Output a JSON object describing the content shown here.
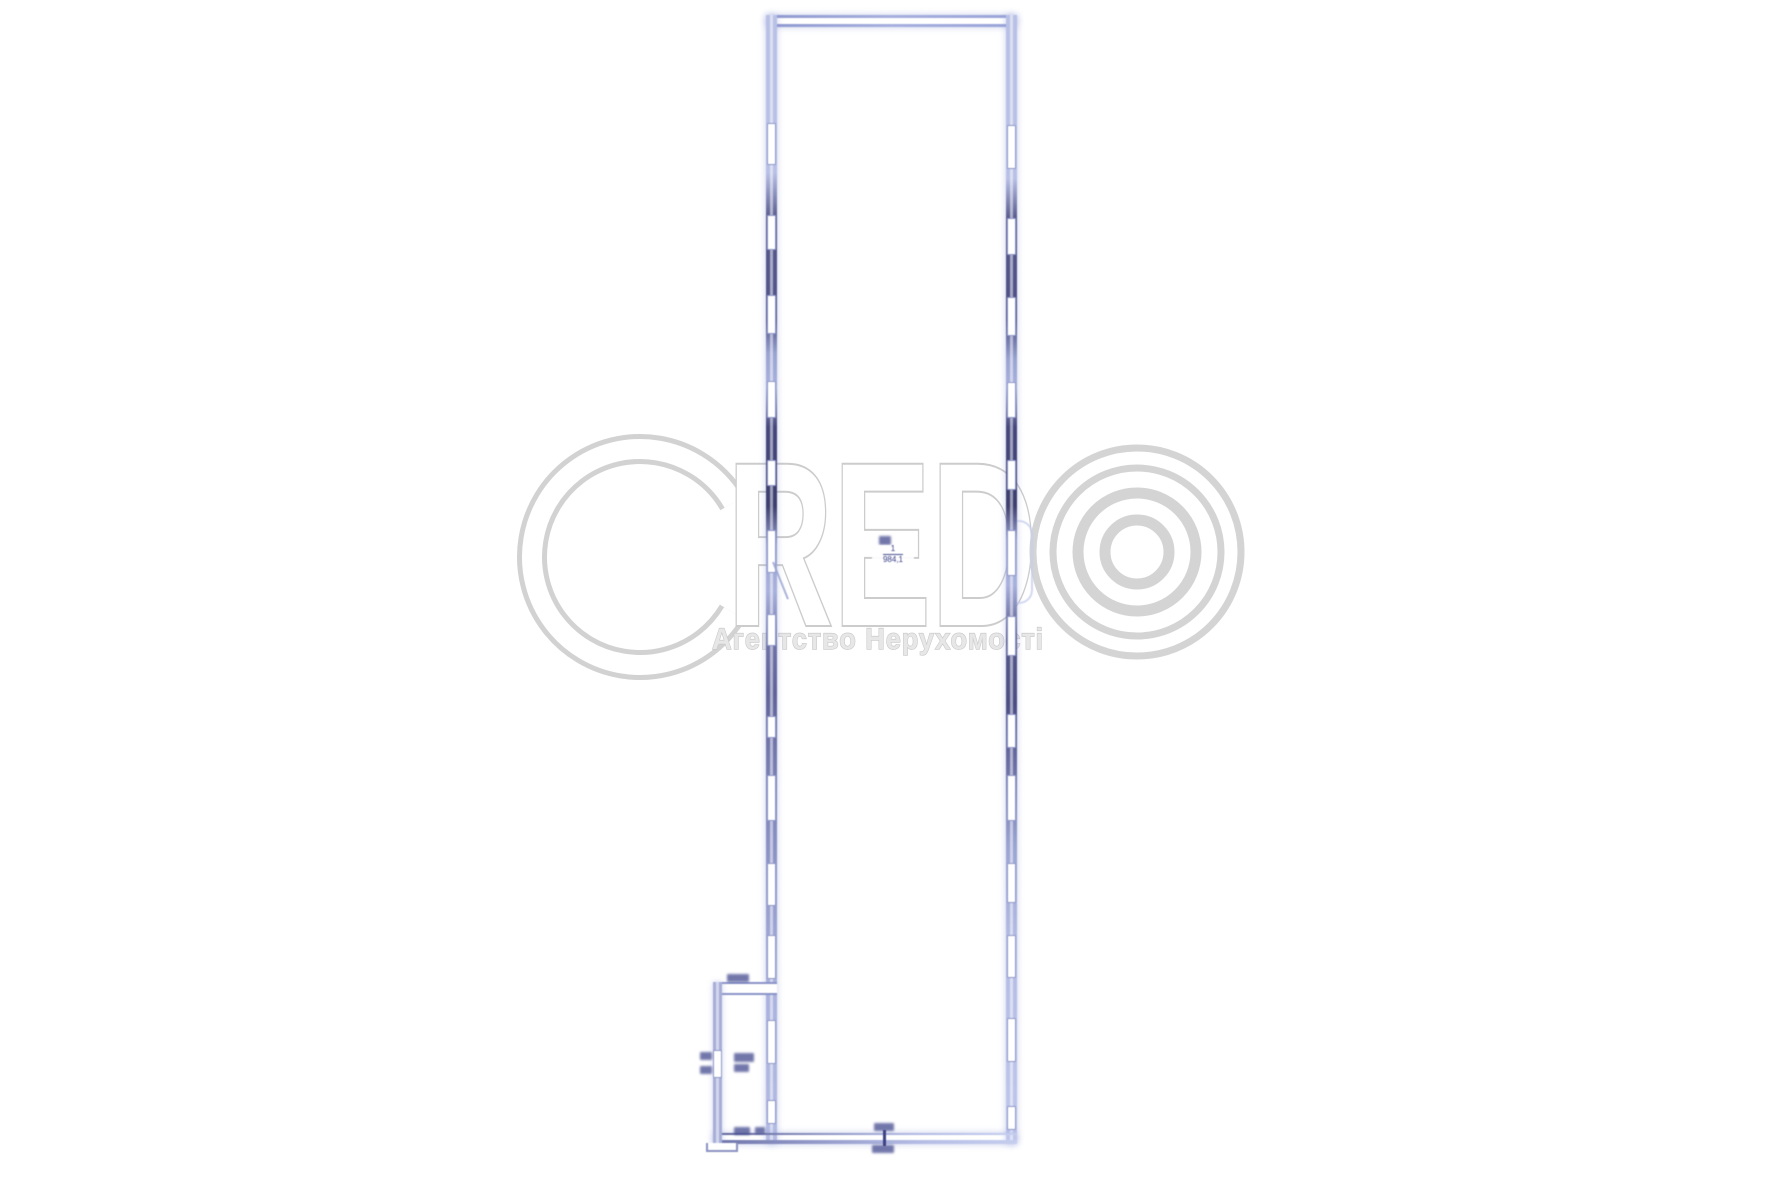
{
  "watermark": {
    "brand": "CREDO",
    "letters_red": "RED",
    "tagline": "Агентство Нерухомості"
  },
  "plan": {
    "room_label": {
      "number": "1",
      "area": "984,1"
    }
  },
  "colors": {
    "wall_light": "#b8c0e6",
    "wall_dark": "#3e3f70",
    "wall_line": "#8f98c8",
    "watermark_gray": "#d2d2d2",
    "label_ink": "#373d85"
  }
}
